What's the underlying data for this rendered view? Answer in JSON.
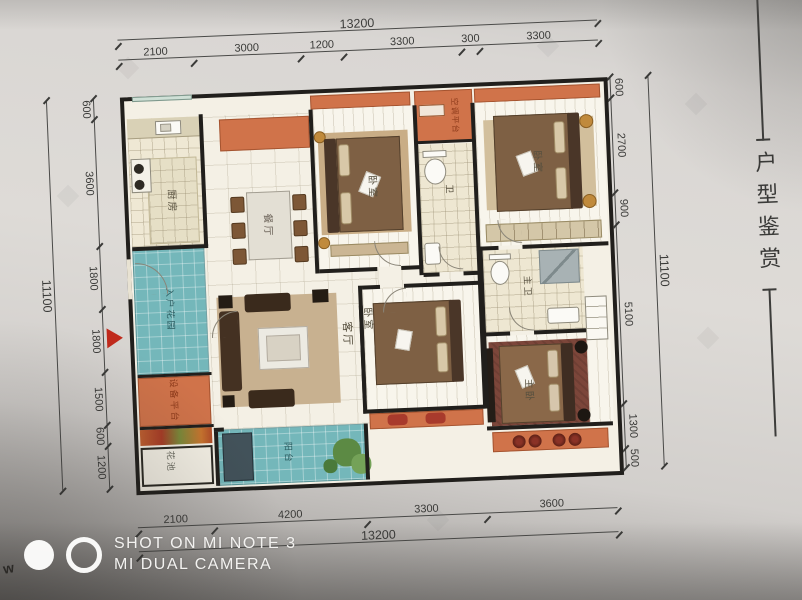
{
  "page": {
    "side_caption": "户型鉴赏",
    "right_edge_cutoff_text": "OOOE",
    "left_edge_mark": "w"
  },
  "watermark": {
    "line1": "SHOT ON MI NOTE 3",
    "line2": "MI DUAL CAMERA"
  },
  "dimensions": {
    "top_total": "13200",
    "top_segments": [
      "2100",
      "3000",
      "1200",
      "3300",
      "300",
      "3300"
    ],
    "bottom_segments": [
      "2100",
      "4200",
      "3300",
      "3600"
    ],
    "bottom_total": "13200",
    "left_total": "11100",
    "left_segments": [
      "600",
      "3600",
      "1800",
      "1800",
      "1500",
      "600",
      "1200"
    ],
    "right_total": "11100",
    "right_segments": [
      "600",
      "2700",
      "900",
      "5100",
      "1300",
      "500"
    ]
  },
  "rooms": {
    "kitchen": "厨房",
    "dining": "餐厅",
    "bedroom_top_left": "卧室",
    "bath": "卫",
    "ac_platform": "空调平台",
    "bedroom_top_right": "卧室",
    "entry_garden": "入户花园",
    "equipment_platform": "设备平台",
    "flower_bed": "花池",
    "living": "客厅",
    "balcony": "阳台",
    "bedroom_bottom": "卧室",
    "master_bath": "主卫",
    "master_bedroom": "主卧"
  },
  "colors": {
    "wall": "#211f1c",
    "orange_platform": "#d0734a",
    "teal_balcony": "#74b7ba",
    "entry_arrow_red": "#c02a1c",
    "paper": "#f4f0e5"
  }
}
